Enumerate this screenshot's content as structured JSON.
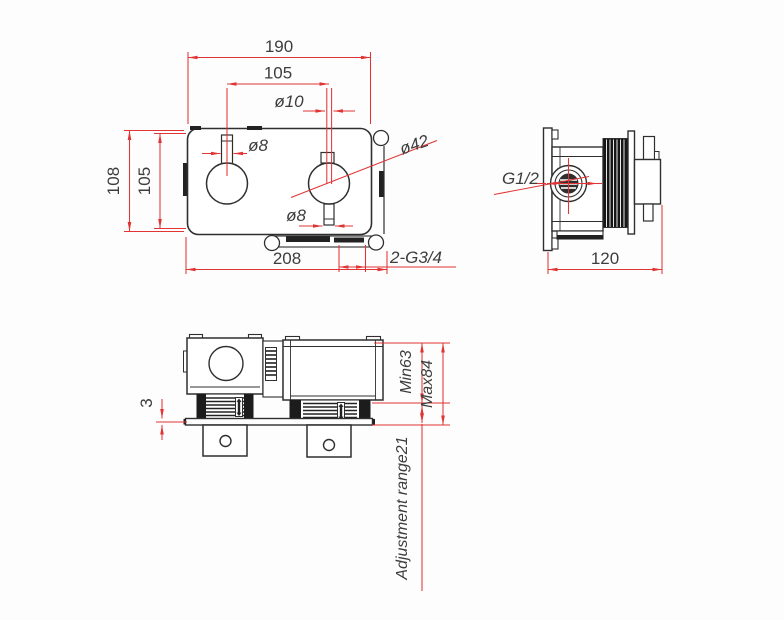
{
  "drawing_type": "technical-dimension-drawing",
  "colors": {
    "dimension_red": "#e13434",
    "line_black": "#2f2f2f",
    "text_gray": "#3d3d3d"
  },
  "front_view": {
    "dim_width_top": "190",
    "dim_knob_spacing": "105",
    "dim_stem_top": "ø10",
    "dim_stem_left": "ø8",
    "dim_knob_diameter": "ø42",
    "dim_stem_bottom": "ø8",
    "dim_height_outer": "108",
    "dim_height_inner": "105",
    "dim_width_bottom": "208",
    "dim_outlet_thread": "2-G3/4"
  },
  "side_view": {
    "dim_inlet_thread": "G1/2",
    "dim_depth": "120"
  },
  "bottom_view": {
    "dim_plate_thickness": "3",
    "dim_min_depth": "Min63",
    "dim_max_depth": "Max84",
    "dim_adjustment_range": "Adjustment range21"
  }
}
